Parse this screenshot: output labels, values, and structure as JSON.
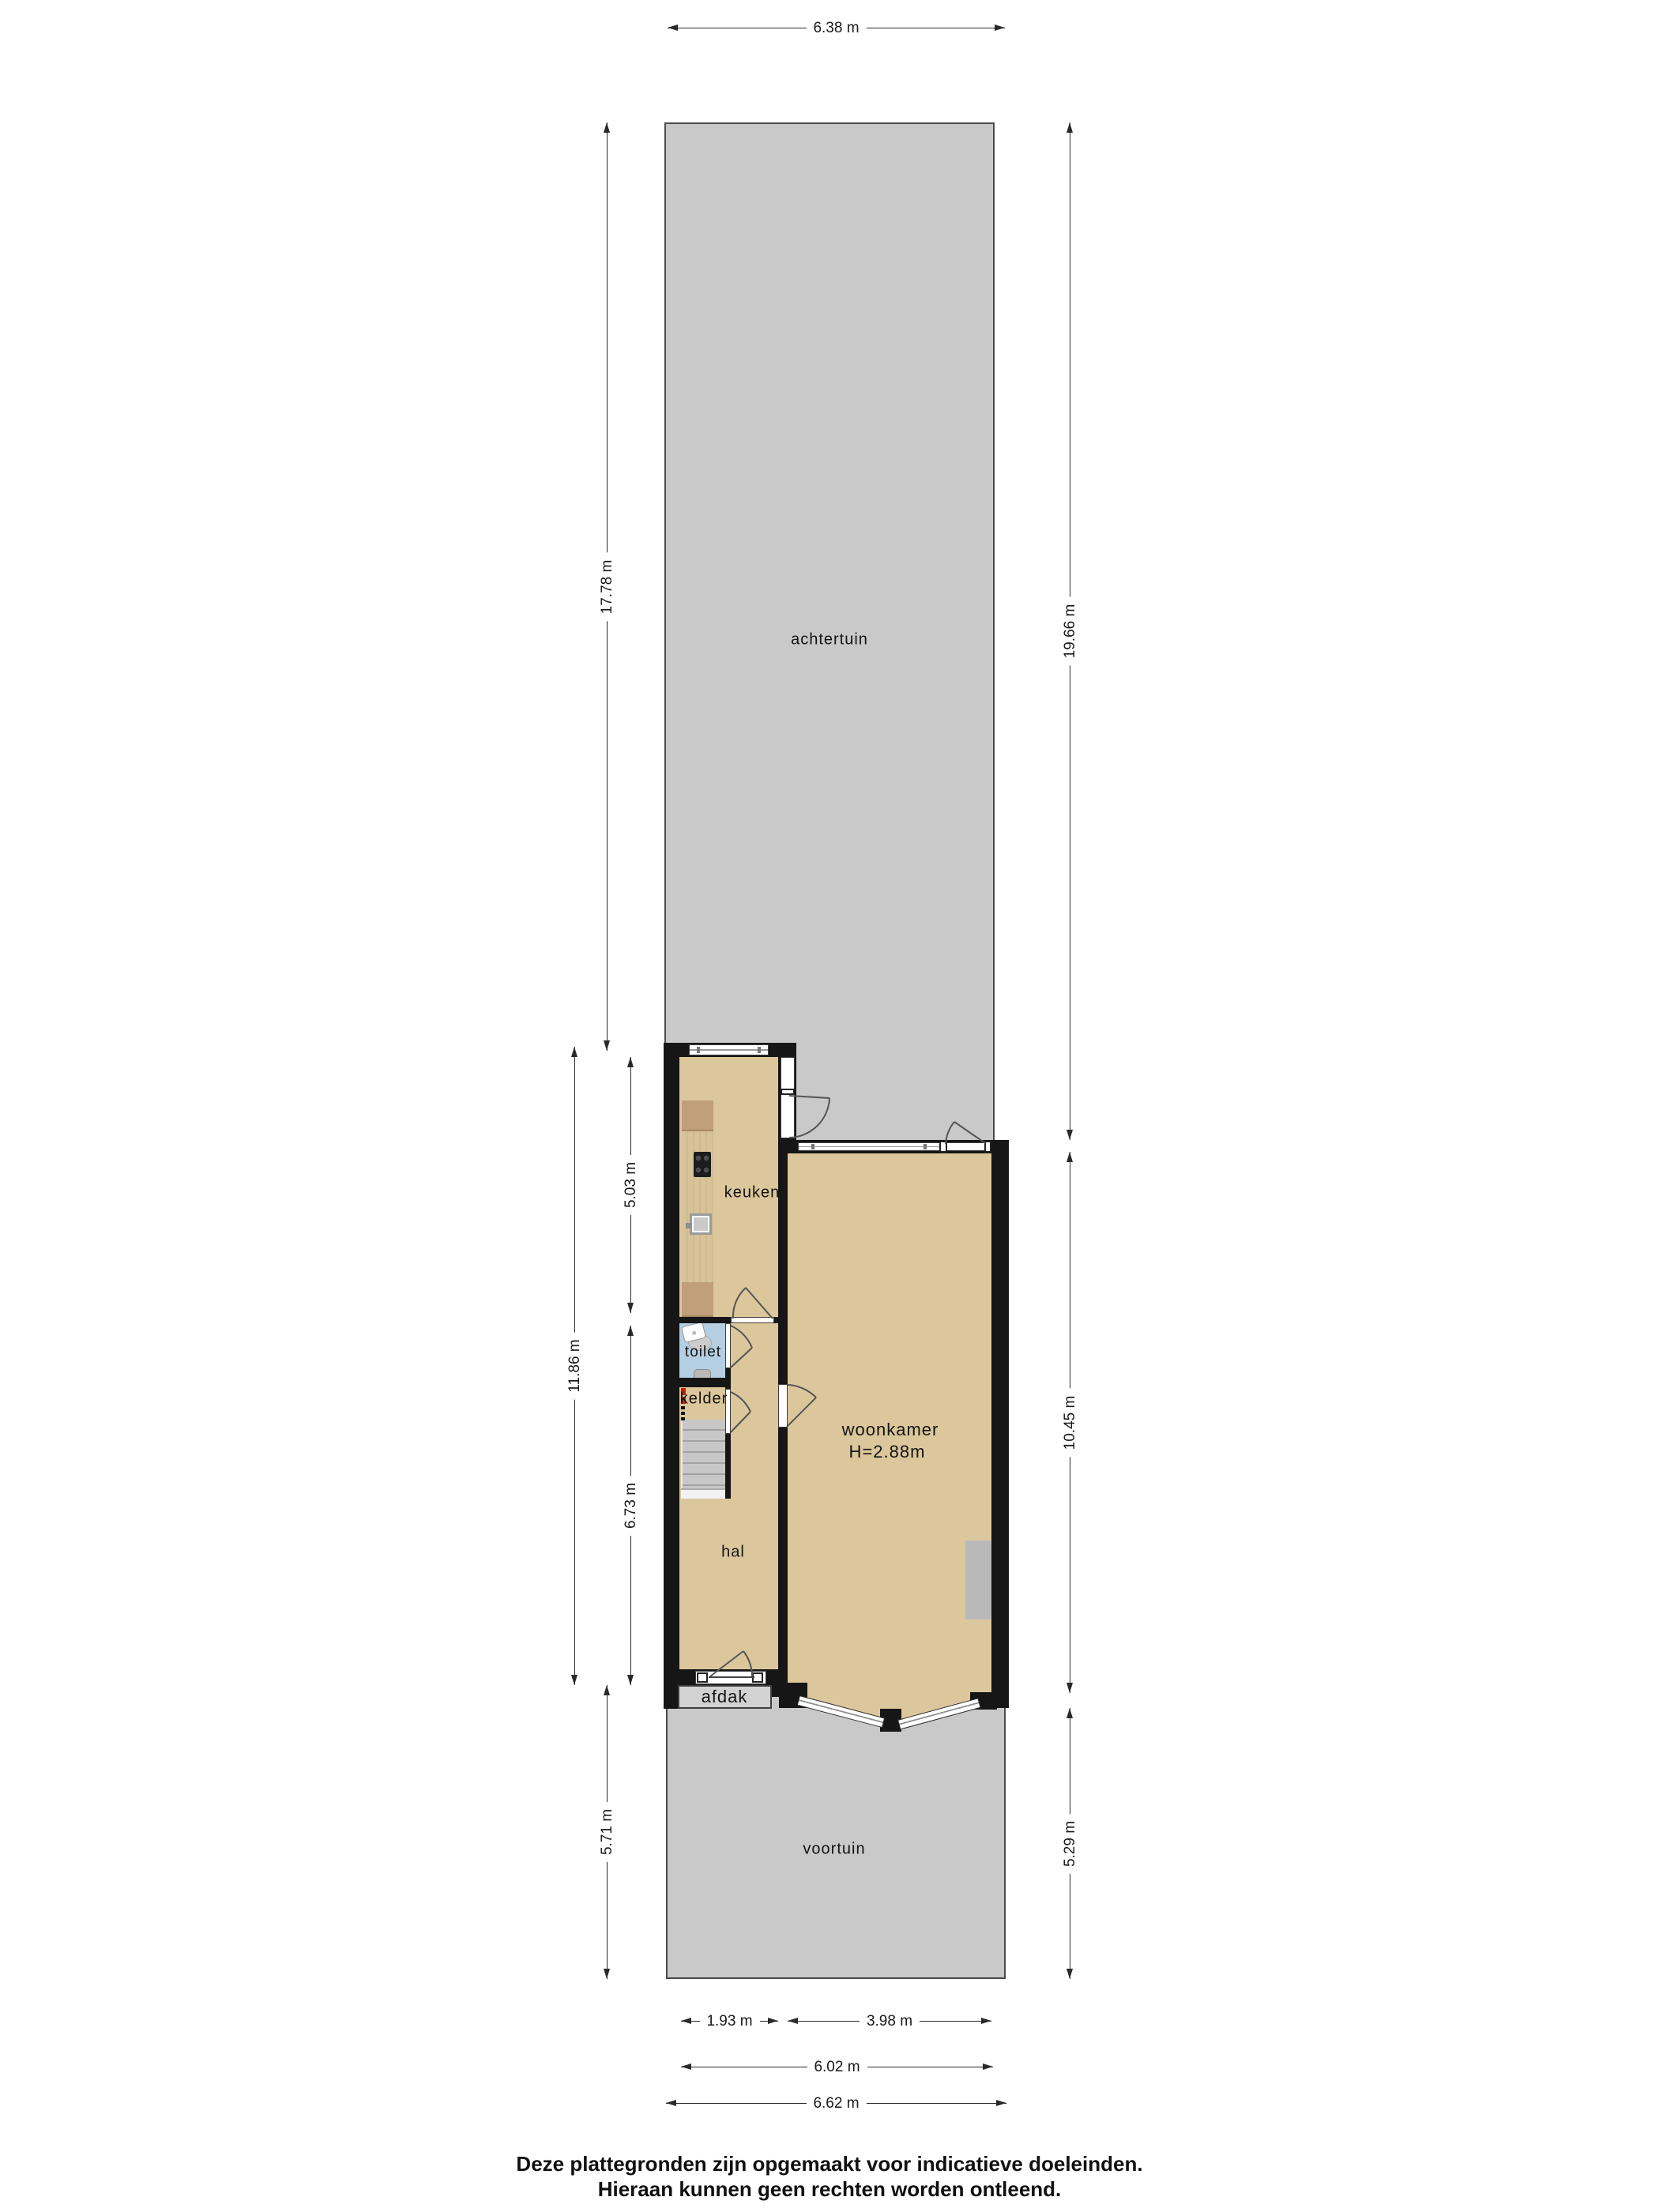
{
  "rooms": {
    "achtertuin": "achtertuin",
    "keuken": "keuken",
    "toilet": "toilet",
    "kelder": "kelder",
    "hal": "hal",
    "woonkamer": "woonkamer",
    "woonkamer_height": "H=2.88m",
    "afdak": "afdak",
    "voortuin": "voortuin"
  },
  "dimensions": {
    "top_width": "6.38 m",
    "left_achtertuin": "17.78 m",
    "left_house_total": "11.86 m",
    "left_keuken": "5.03 m",
    "left_hal": "6.73 m",
    "left_voortuin": "5.71 m",
    "right_achtertuin": "19.66 m",
    "right_woonkamer": "10.45 m",
    "right_voortuin": "5.29 m",
    "bottom_keuken": "1.93 m",
    "bottom_woonkamer": "3.98 m",
    "bottom_inner": "6.02 m",
    "bottom_outer": "6.62 m"
  },
  "footer": {
    "line1": "Deze plattegronden zijn opgemaakt voor indicatieve doeleinden.",
    "line2": "Hieraan kunnen geen rechten worden ontleend."
  },
  "colors": {
    "wall": "#161616",
    "floor": "#dcc69b",
    "garden": "#c9c9c9",
    "garden_border": "#4a4a4a",
    "toilet_floor": "#b4cfe1",
    "counter_wood": "#d8c298",
    "counter_wood_dark": "#bfa07a",
    "stair_line": "#a2a2a2",
    "afdak": "#d2d2d2",
    "gray_rect": "#b9b9b9",
    "accent_red": "#c22200",
    "dimension": "#2a2a2a",
    "door_arc": "#555555",
    "frame": "#3d3d3d"
  }
}
